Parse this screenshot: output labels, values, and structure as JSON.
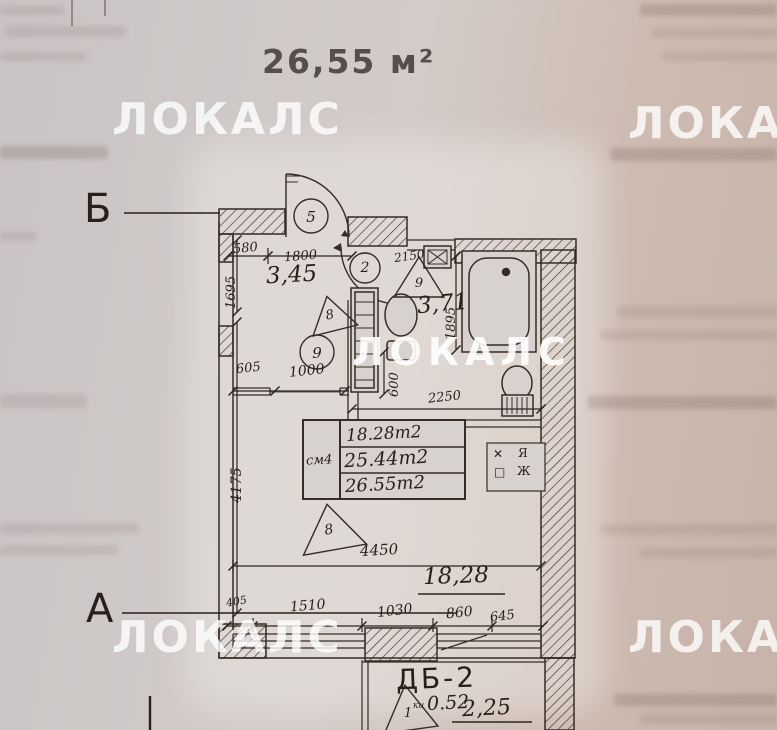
{
  "title": "26,55 м²",
  "watermark": "ЛОКАЛС",
  "axis": {
    "top": "Б",
    "bottom": "А"
  },
  "rooms": {
    "hall_area": "3,45",
    "bath_area": "3,71"
  },
  "dims": {
    "d580": "580",
    "d1800": "1800",
    "d1695": "1695",
    "d2150": "2150",
    "d1895": "1895",
    "d605": "605",
    "d1000": "1000",
    "d600": "600",
    "d2250": "2250",
    "d4175": "4175",
    "d4450": "4450",
    "d1828": "18,28",
    "d405": "405",
    "d1510": "1510",
    "d1030": "1030",
    "d860": "860",
    "d645": "645"
  },
  "markers": {
    "c5": "5",
    "c2": "2",
    "c9": "9",
    "t9": "9",
    "t8_hall": "8",
    "t8_room": "8",
    "t1": "1"
  },
  "table": {
    "label": "см4",
    "rows": [
      "18.28m2",
      "25.44m2",
      "26.55m2"
    ]
  },
  "symbols": [
    "✕",
    "Я",
    "□",
    "Ж"
  ],
  "balcony": {
    "label": "ДБ-2",
    "prefix": "ки",
    "v1": "0.52",
    "v2": "2,25"
  }
}
